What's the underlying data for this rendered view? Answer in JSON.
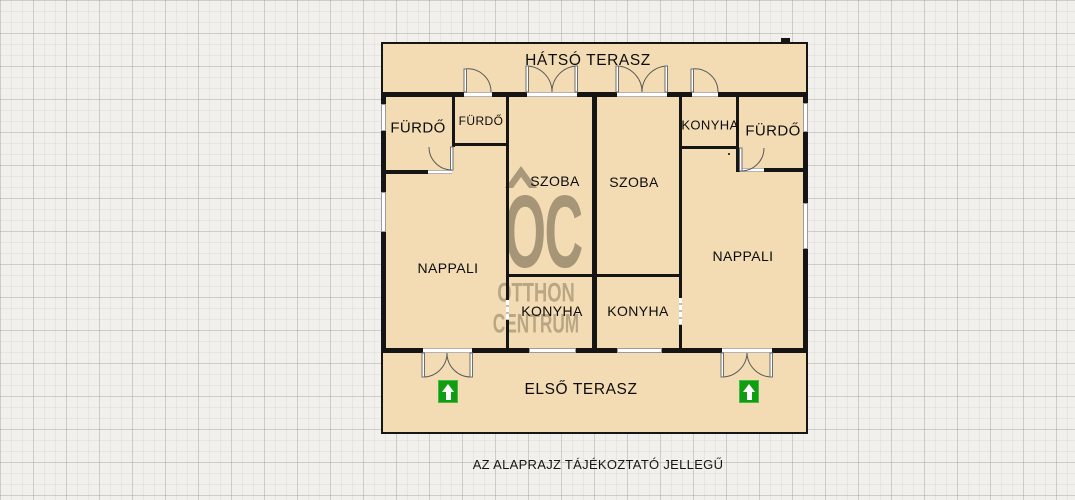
{
  "floorplan": {
    "labels": {
      "back_terrace": "HÁTSÓ TERASZ",
      "front_terrace": "ELSŐ TERASZ",
      "bathroom_left": "FÜRDŐ",
      "bathroom_left_small": "FÜRDŐ",
      "kitchen_top_right": "KONYHA",
      "bathroom_right": "FÜRDŐ",
      "room_left": "SZOBA",
      "room_right": "SZOBA",
      "living_room_left": "NAPPALI",
      "living_room_right": "NAPPALI",
      "kitchen_left": "KONYHA",
      "kitchen_right": "KONYHA"
    },
    "watermark": {
      "initials": "OC",
      "brand_line1": "OTTHON",
      "brand_line2": "CENTRUM"
    },
    "caption": "AZ ALAPRAJZ TÁJÉKOZTATÓ JELLEGŰ",
    "colors": {
      "floor_fill": "#f3dcb4",
      "wall": "#151515",
      "entrance_arrow_green": "#0f9e0f",
      "watermark": "rgba(95,84,63,0.5)",
      "paper_background": "#f1f0ec"
    }
  }
}
